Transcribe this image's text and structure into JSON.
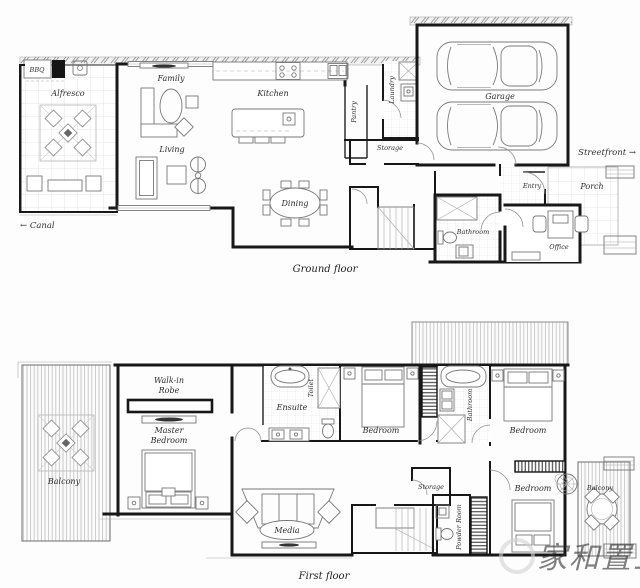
{
  "ground": {
    "caption": "Ground floor",
    "canal": "← Canal",
    "streetfront": "Streetfront →",
    "rooms": {
      "bbq": "BBQ",
      "alfresco": "Alfresco",
      "family": "Family",
      "living": "Living",
      "kitchen": "Kitchen",
      "pantry": "Pantry",
      "laundry": "Laundry",
      "storage": "Storage",
      "dining": "Dining",
      "garage": "Garage",
      "entry": "Entry",
      "porch": "Porch",
      "office": "Office",
      "bathroom": "Bathroom"
    }
  },
  "first": {
    "caption": "First floor",
    "rooms": {
      "balcony_left": "Balcony",
      "walk_in_robe_line1": "Walk-in",
      "walk_in_robe_line2": "Robe",
      "master_line1": "Master",
      "master_line2": "Bedroom",
      "ensuite": "Ensuite",
      "toilet": "Toilet",
      "bedroom_mid": "Bedroom",
      "bathroom": "Bathroom",
      "bedroom_right": "Bedroom",
      "storage": "Storage",
      "media": "Media",
      "powder": "Powder Room",
      "bedroom_bottom": "Bedroom",
      "balcony_right": "Balcony"
    }
  },
  "watermark": {
    "text": "家和置业"
  },
  "colors": {
    "wall": "#181818",
    "furniture": "#777777",
    "label": "#2d2d2d",
    "watermark": "#d6d6d6"
  }
}
